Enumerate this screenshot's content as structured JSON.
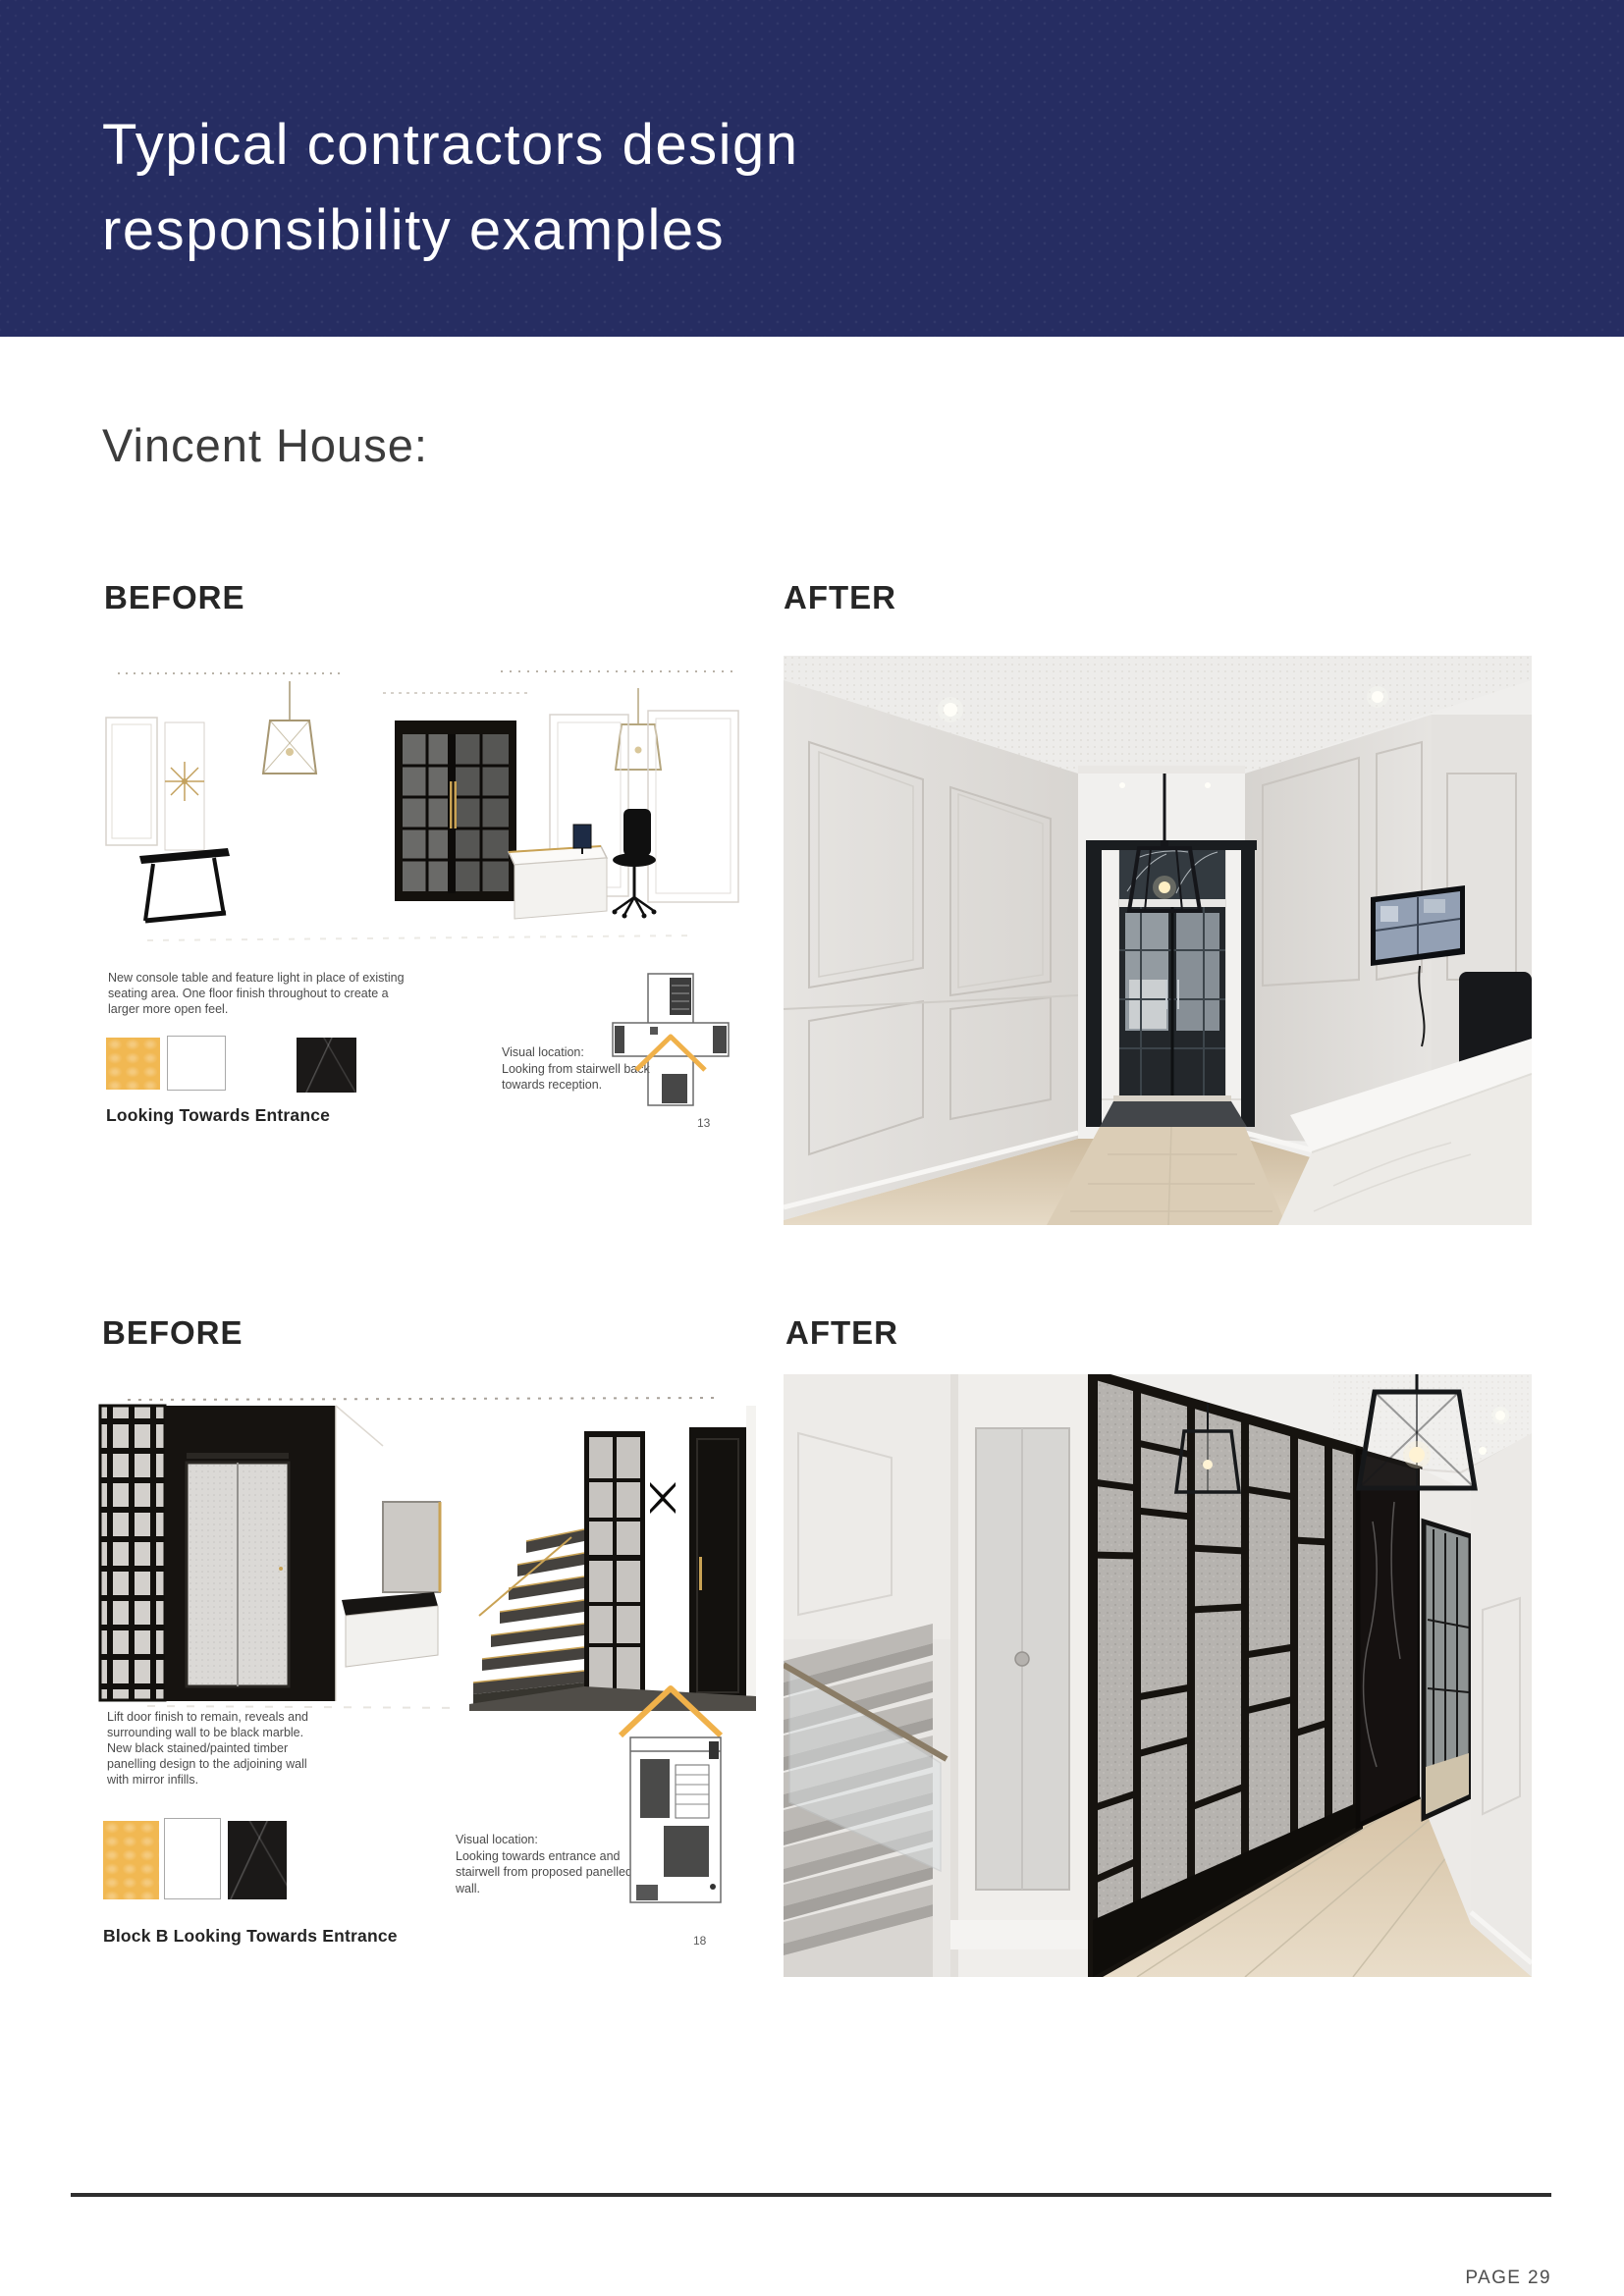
{
  "header": {
    "bg_color": "#262d62",
    "text_color": "#ffffff",
    "title_line1": "Typical contractors design",
    "title_line2": "responsibility examples"
  },
  "subtitle": "Vincent House:",
  "rows": [
    {
      "before_label": "BEFORE",
      "after_label": "AFTER",
      "panel": {
        "note": "New console table and feature light in place of existing seating area. One floor finish throughout to create a larger more open feel.",
        "swatches": [
          "#f1b852",
          "#ffffff",
          "#1b1918"
        ],
        "caption": "Looking Towards Entrance",
        "visual_location_title": "Visual location:",
        "visual_location_text": "Looking from stairwell back towards reception.",
        "page_no": "13"
      }
    },
    {
      "before_label": "BEFORE",
      "after_label": "AFTER",
      "panel": {
        "note": "Lift door finish to remain, reveals and surrounding wall to be black marble. New black stained/painted timber panelling design to the adjoining wall with mirror infills.",
        "swatches": [
          "#f1b852",
          "#ffffff",
          "#1b1918"
        ],
        "caption": "Block B Looking Towards Entrance",
        "visual_location_title": "Visual location:",
        "visual_location_text": "Looking towards entrance and stairwell from proposed panelled wall.",
        "page_no": "18"
      }
    }
  ],
  "footer": {
    "page_label": "PAGE 29"
  },
  "colors": {
    "navy": "#262d62",
    "gold_swatch": "#f1b852",
    "black_marble_swatch": "#1b1918",
    "footer_line": "#2e2e2e",
    "plan_arrow": "#f0b14a"
  }
}
